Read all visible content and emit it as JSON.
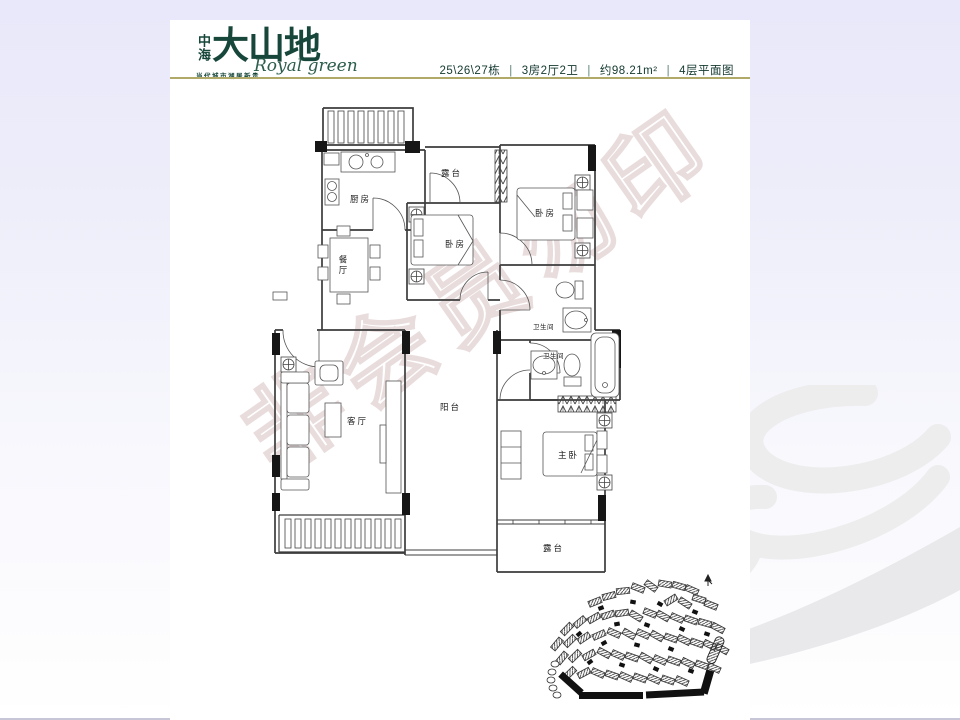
{
  "header": {
    "logo": {
      "prefix": "中海",
      "name": "大山地",
      "script": "Royal green",
      "slogan": "当代城市湖居新贵"
    },
    "info": {
      "building": "25\\26\\27栋",
      "layout": "3房2厅2卫",
      "area": "约98.21m²",
      "floor": "4层平面图",
      "sep": "|"
    },
    "colors": {
      "logo_green": "#17463a",
      "gold_rule": "#b1a967"
    }
  },
  "floorplan": {
    "rooms": {
      "kitchen": "厨房",
      "dining": "餐厅",
      "terrace_top": "露台",
      "bedroom1": "卧房",
      "bedroom2": "卧房",
      "bath1": "卫生间",
      "bath2": "卫生间",
      "living": "客厅",
      "balcony": "阳台",
      "master": "主卧",
      "terrace_bottom": "露台"
    },
    "line_color": "#3c3c3c"
  },
  "watermark": {
    "text": "非会员勿印",
    "color": "#e9dcdc"
  },
  "siteplan": {
    "buildings": [
      [
        52,
        30,
        -22
      ],
      [
        66,
        24,
        -14
      ],
      [
        80,
        19,
        -6
      ],
      [
        95,
        16,
        22
      ],
      [
        108,
        14,
        36
      ],
      [
        122,
        12,
        10
      ],
      [
        136,
        14,
        16
      ],
      [
        149,
        18,
        24
      ],
      [
        128,
        28,
        -32
      ],
      [
        142,
        31,
        33
      ],
      [
        156,
        27,
        18
      ],
      [
        168,
        33,
        22
      ],
      [
        24,
        57,
        -46
      ],
      [
        37,
        50,
        -40
      ],
      [
        51,
        46,
        -30
      ],
      [
        65,
        43,
        -18
      ],
      [
        79,
        41,
        -8
      ],
      [
        93,
        44,
        32
      ],
      [
        107,
        41,
        22
      ],
      [
        120,
        44,
        30
      ],
      [
        134,
        46,
        24
      ],
      [
        148,
        48,
        20
      ],
      [
        162,
        51,
        16
      ],
      [
        175,
        56,
        28
      ],
      [
        14,
        72,
        -50
      ],
      [
        27,
        69,
        -44
      ],
      [
        41,
        66,
        -34
      ],
      [
        56,
        63,
        -24
      ],
      [
        71,
        61,
        24
      ],
      [
        86,
        62,
        30
      ],
      [
        100,
        62,
        24
      ],
      [
        114,
        64,
        30
      ],
      [
        128,
        66,
        20
      ],
      [
        141,
        68,
        26
      ],
      [
        154,
        71,
        20
      ],
      [
        167,
        73,
        26
      ],
      [
        179,
        77,
        30
      ],
      [
        19,
        86,
        -50
      ],
      [
        32,
        84,
        -44
      ],
      [
        46,
        83,
        -30
      ],
      [
        61,
        81,
        28
      ],
      [
        75,
        83,
        24
      ],
      [
        89,
        85,
        20
      ],
      [
        103,
        86,
        30
      ],
      [
        117,
        88,
        24
      ],
      [
        131,
        89,
        20
      ],
      [
        145,
        91,
        26
      ],
      [
        159,
        93,
        20
      ],
      [
        171,
        96,
        24
      ],
      [
        27,
        101,
        -44
      ],
      [
        41,
        101,
        -28
      ],
      [
        55,
        101,
        24
      ],
      [
        69,
        103,
        20
      ],
      [
        83,
        105,
        24
      ],
      [
        97,
        106,
        20
      ],
      [
        111,
        107,
        24
      ],
      [
        125,
        108,
        20
      ],
      [
        139,
        109,
        24
      ]
    ],
    "marks": [
      [
        58,
        36,
        -20
      ],
      [
        90,
        30,
        10
      ],
      [
        117,
        32,
        30
      ],
      [
        74,
        52,
        -10
      ],
      [
        104,
        53,
        20
      ],
      [
        139,
        57,
        25
      ],
      [
        61,
        71,
        -30
      ],
      [
        94,
        73,
        15
      ],
      [
        128,
        77,
        22
      ],
      [
        79,
        93,
        18
      ],
      [
        113,
        97,
        24
      ],
      [
        148,
        99,
        20
      ],
      [
        47,
        90,
        -35
      ],
      [
        164,
        62,
        18
      ],
      [
        36,
        62,
        -40
      ],
      [
        152,
        40,
        22
      ]
    ],
    "roads": [
      [
        36,
        120,
        64,
        7,
        0
      ],
      [
        103,
        118,
        58,
        7,
        -3
      ],
      [
        14,
        108,
        28,
        7,
        42
      ],
      [
        160,
        98,
        8,
        24,
        16
      ]
    ]
  }
}
